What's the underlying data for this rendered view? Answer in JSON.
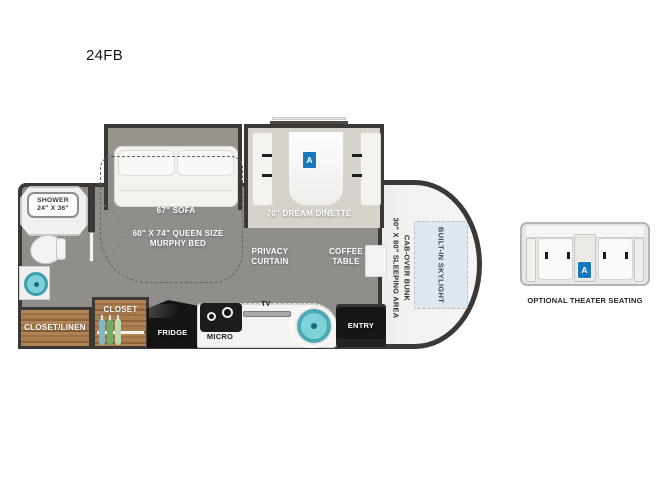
{
  "title": "24FB",
  "colors": {
    "accent_blue": "#1878bd",
    "floor_gray": "#908e8b",
    "wall_dark": "#3b3836",
    "wood_brown": "#a87c50",
    "sink_teal": "#7fd2d8",
    "skylight_blue": "#dde8f0",
    "dinette_floor": "#d7d3ca"
  },
  "floorplan": {
    "labels": {
      "shower_l1": "SHOWER",
      "shower_l2": "24\" X 36\"",
      "sofa": "67\" SOFA",
      "dinette": "70\" DREAM DINETTE",
      "murphy_l1": "60\" X 74\" QUEEN SIZE",
      "murphy_l2": "MURPHY BED",
      "privacy_l1": "PRIVACY",
      "privacy_l2": "CURTAIN",
      "coffee_l1": "COFFEE",
      "coffee_l2": "TABLE",
      "closet": "CLOSET",
      "closet_linen": "CLOSET/LINEN",
      "fridge": "FRIDGE",
      "micro": "MICRO",
      "tv": "TV",
      "entry": "ENTRY",
      "cab_bunk_l1": "CAB-OVER BUNK",
      "cab_bunk_l2": "30\" X 80\" SLEEPING AREA",
      "skylight": "BUILT-IN SKYLIGHT",
      "marker_a": "A"
    }
  },
  "inset": {
    "label": "OPTIONAL THEATER SEATING",
    "marker": "A"
  }
}
